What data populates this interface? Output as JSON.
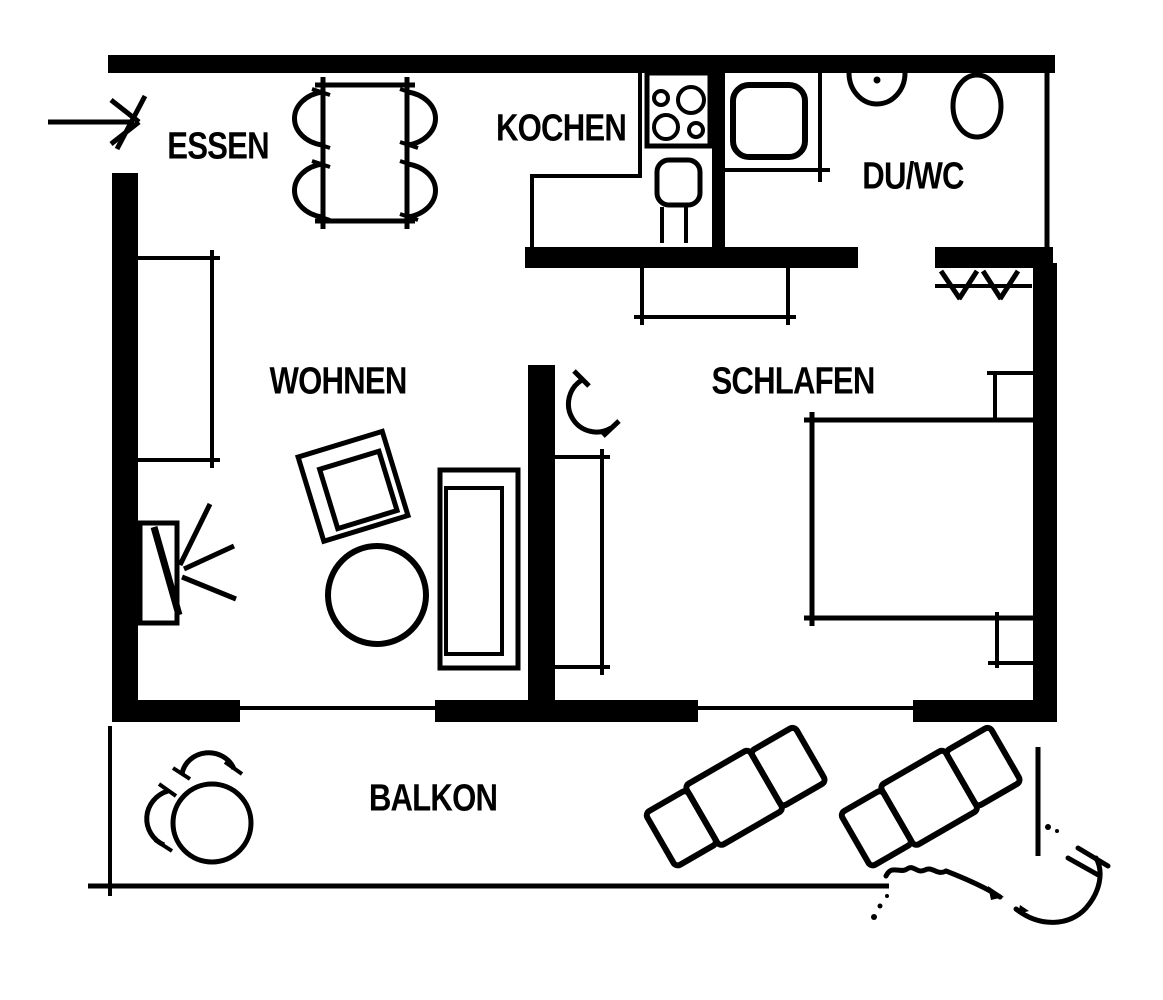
{
  "colors": {
    "ink": "#000000",
    "paper": "#ffffff"
  },
  "rooms": {
    "essen": {
      "label": "ESSEN"
    },
    "kochen": {
      "label": "KOCHEN"
    },
    "duwc": {
      "label": "DU/WC"
    },
    "wohnen": {
      "label": "WOHNEN"
    },
    "schlafen": {
      "label": "SCHLAFEN"
    },
    "balkon": {
      "label": "BALKON"
    }
  },
  "symbols": {
    "entrance": "entrance-arrow",
    "essen": [
      "dining-table",
      "dining-chair",
      "sideboard"
    ],
    "kochen": [
      "cooktop-4-burners",
      "sink-unit",
      "kitchen-counter"
    ],
    "duwc": [
      "shower-tray",
      "washbasin",
      "toilet"
    ],
    "wohnen": [
      "sofa",
      "armchair",
      "coffee-table",
      "tv-with-signal-rays",
      "dresser"
    ],
    "schlafen": [
      "double-bed",
      "nightstand",
      "wardrobe",
      "clothes-rail-hatch",
      "door-swing"
    ],
    "balkon": [
      "round-table",
      "balcony-chair",
      "sun-lounger",
      "hand-drawn-flourish"
    ]
  }
}
